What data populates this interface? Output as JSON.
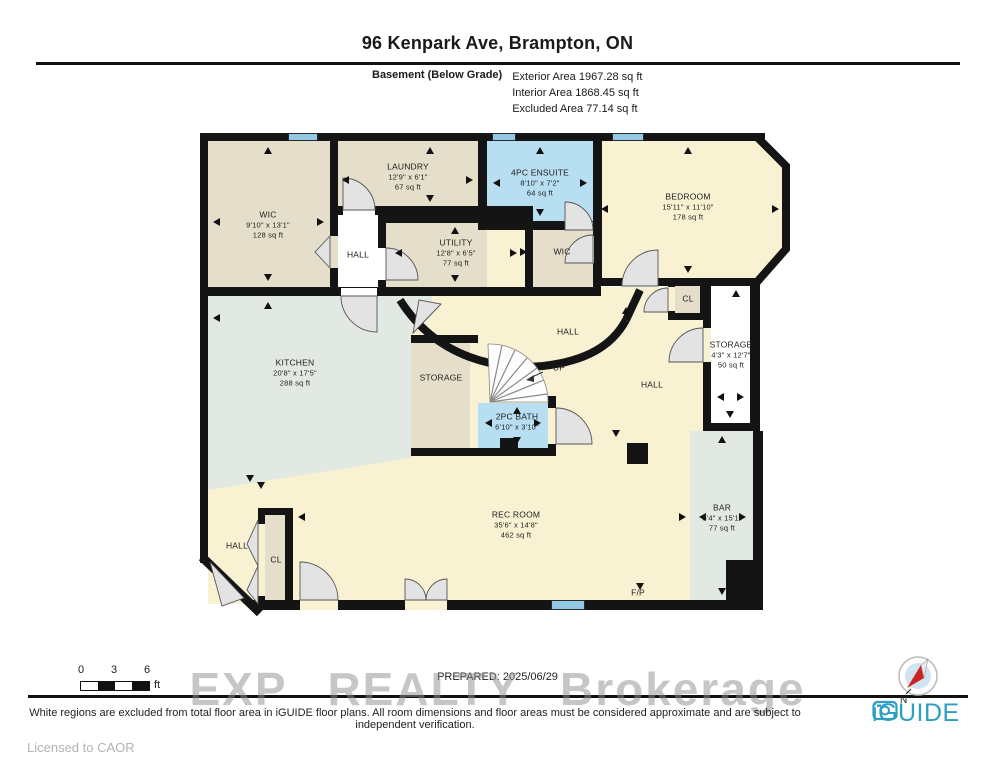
{
  "header": {
    "title": "96 Kenpark Ave, Brampton, ON",
    "floor_label": "Basement (Below Grade)",
    "areas": [
      {
        "label": "Exterior Area",
        "value": "1967.28 sq ft"
      },
      {
        "label": "Interior Area",
        "value": "1868.45 sq ft"
      },
      {
        "label": "Excluded Area",
        "value": "77.14 sq ft"
      }
    ]
  },
  "rooms": {
    "wic1": {
      "name": "WIC",
      "dim": "9'10\" x 13'1\"",
      "area": "128 sq ft"
    },
    "laundry": {
      "name": "LAUNDRY",
      "dim": "12'9\" x 6'1\"",
      "area": "67 sq ft"
    },
    "hall1": {
      "name": "HALL"
    },
    "utility": {
      "name": "UTILITY",
      "dim": "12'8\" x 6'5\"",
      "area": "77 sq ft"
    },
    "ensuite": {
      "name": "4PC ENSUITE",
      "dim": "8'10\" x 7'2\"",
      "area": "64 sq ft"
    },
    "wic2": {
      "name": "WIC"
    },
    "bedroom": {
      "name": "BEDROOM",
      "dim": "15'11\" x 11'10\"",
      "area": "178 sq ft"
    },
    "cl1": {
      "name": "CL"
    },
    "storage_r": {
      "name": "STORAGE",
      "dim": "4'3\" x 12'7\"",
      "area": "50 sq ft"
    },
    "kitchen": {
      "name": "KITCHEN",
      "dim": "20'8\" x 17'5\"",
      "area": "288 sq ft"
    },
    "storage_m": {
      "name": "STORAGE"
    },
    "hall2": {
      "name": "HALL"
    },
    "hall3": {
      "name": "HALL"
    },
    "up": {
      "name": "UP"
    },
    "bath": {
      "name": "2PC BATH",
      "dim": "6'10\" x 3'10\""
    },
    "recroom": {
      "name": "REC ROOM",
      "dim": "35'6\" x 14'8\"",
      "area": "462 sq ft"
    },
    "bar": {
      "name": "BAR",
      "dim": "5'4\" x 15'1\"",
      "area": "77 sq ft"
    },
    "hall4": {
      "name": "HALL"
    },
    "cl2": {
      "name": "CL"
    },
    "fp": {
      "name": "F/P"
    }
  },
  "footer": {
    "prepared": "PREPARED: 2025/06/29",
    "watermark": "EXP REALTY Brokerage",
    "disclaimer": "White regions are excluded from total floor area in iGUIDE floor plans. All room dimensions and floor areas must be considered approximate and are subject to independent verification.",
    "licensed": "Licensed to CAOR",
    "brand": "iGUIDE",
    "compass_north": "N",
    "scale": {
      "t0": "0",
      "t1": "3",
      "t2": "6",
      "unit": "ft"
    }
  },
  "colors": {
    "wall": "#141414",
    "room_tan": "#e5decb",
    "room_cream": "#f9f2d2",
    "room_blue": "#b8def2",
    "room_green": "#e2e9e2",
    "room_white": "#ffffff",
    "window_blue": "#93c9e4",
    "brand_teal": "#2d9fc3"
  }
}
